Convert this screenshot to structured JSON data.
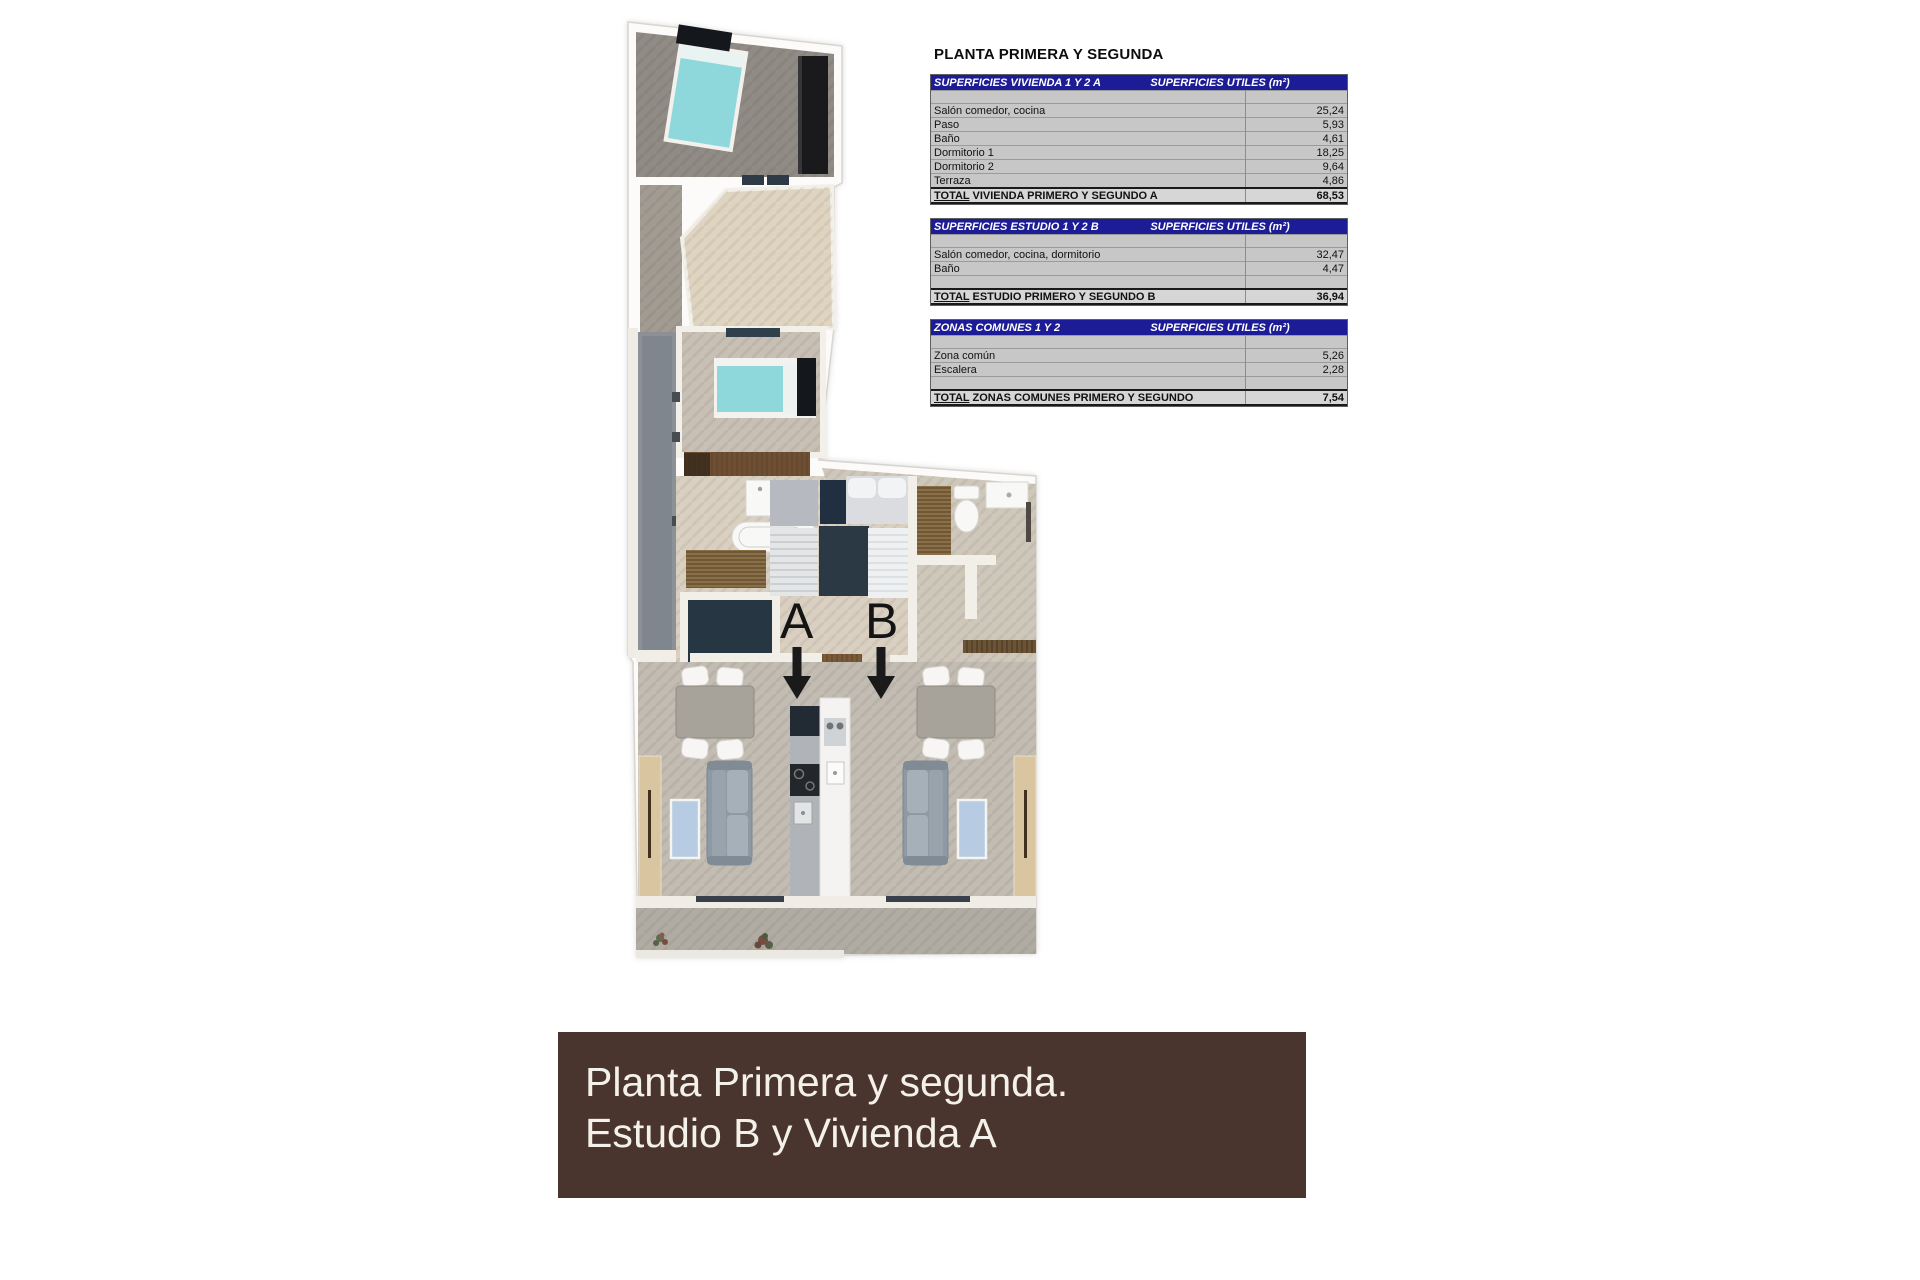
{
  "tables_title": "PLANTA PRIMERA Y SEGUNDA",
  "tables": [
    {
      "header_left": "SUPERFICIES VIVIENDA 1 Y 2 A",
      "header_right": "SUPERFICIES UTILES  (m²)",
      "rows": [
        {
          "label": "",
          "value": ""
        },
        {
          "label": "Salón comedor, cocina",
          "value": "25,24"
        },
        {
          "label": "Paso",
          "value": "5,93"
        },
        {
          "label": "Baño",
          "value": "4,61"
        },
        {
          "label": "Dormitorio 1",
          "value": "18,25"
        },
        {
          "label": "Dormitorio 2",
          "value": "9,64"
        },
        {
          "label": "Terraza",
          "value": "4,86"
        }
      ],
      "total": {
        "prefix": "TOTAL",
        "label": "VIVIENDA PRIMERO Y SEGUNDO A",
        "value": "68,53"
      }
    },
    {
      "header_left": "SUPERFICIES ESTUDIO 1 Y 2 B",
      "header_right": "SUPERFICIES UTILES  (m²)",
      "rows": [
        {
          "label": "",
          "value": ""
        },
        {
          "label": "Salón comedor, cocina, dormitorio",
          "value": "32,47"
        },
        {
          "label": "Baño",
          "value": "4,47"
        },
        {
          "label": "",
          "value": ""
        }
      ],
      "total": {
        "prefix": "TOTAL",
        "label": "ESTUDIO PRIMERO Y SEGUNDO B",
        "value": "36,94"
      }
    },
    {
      "header_left": "ZONAS COMUNES 1 Y 2",
      "header_right": "SUPERFICIES UTILES  (m²)",
      "rows": [
        {
          "label": "",
          "value": ""
        },
        {
          "label": "Zona común",
          "value": "5,26"
        },
        {
          "label": "Escalera",
          "value": "2,28"
        },
        {
          "label": "",
          "value": ""
        }
      ],
      "total": {
        "prefix": "TOTAL",
        "label": "ZONAS COMUNES PRIMERO Y SEGUNDO",
        "value": "7,54"
      }
    }
  ],
  "floor_plan": {
    "unit_a_label": "A",
    "unit_b_label": "B"
  },
  "banner": {
    "line1": "Planta Primera y segunda.",
    "line2": "Estudio B y Vivienda A"
  },
  "colors": {
    "table_header_bg": "#1c1c96",
    "table_row_bg": "#c7c7c7",
    "banner_bg": "#4a352e",
    "bed_teal": "#8ed8dc",
    "rug_blue": "#b7cbe3",
    "wood_brown": "#8a7048"
  }
}
